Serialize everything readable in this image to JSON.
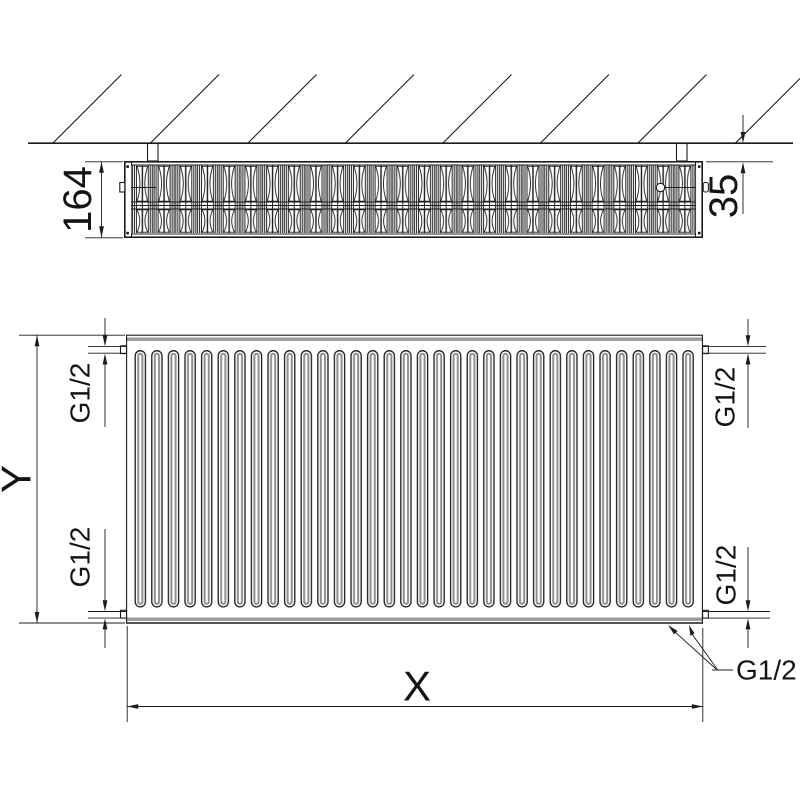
{
  "drawing": {
    "kind": "panel radiator technical dimension drawing, top view and front view",
    "colors": {
      "line": "#1c1c1c",
      "fin_gray": "#8f8f8f",
      "band_gray": "#9a9a9a",
      "background": "#ffffff"
    },
    "top_view": {
      "depth_label": "164",
      "wall_distance_label": "35"
    },
    "front_view": {
      "height_label": "Y",
      "width_label": "X",
      "thread_top_left": "G1/2",
      "thread_top_right": "G1/2",
      "thread_bottom_left": "G1/2",
      "thread_bottom_right": "G1/2",
      "thread_bottom_connections": "G1/2"
    }
  }
}
